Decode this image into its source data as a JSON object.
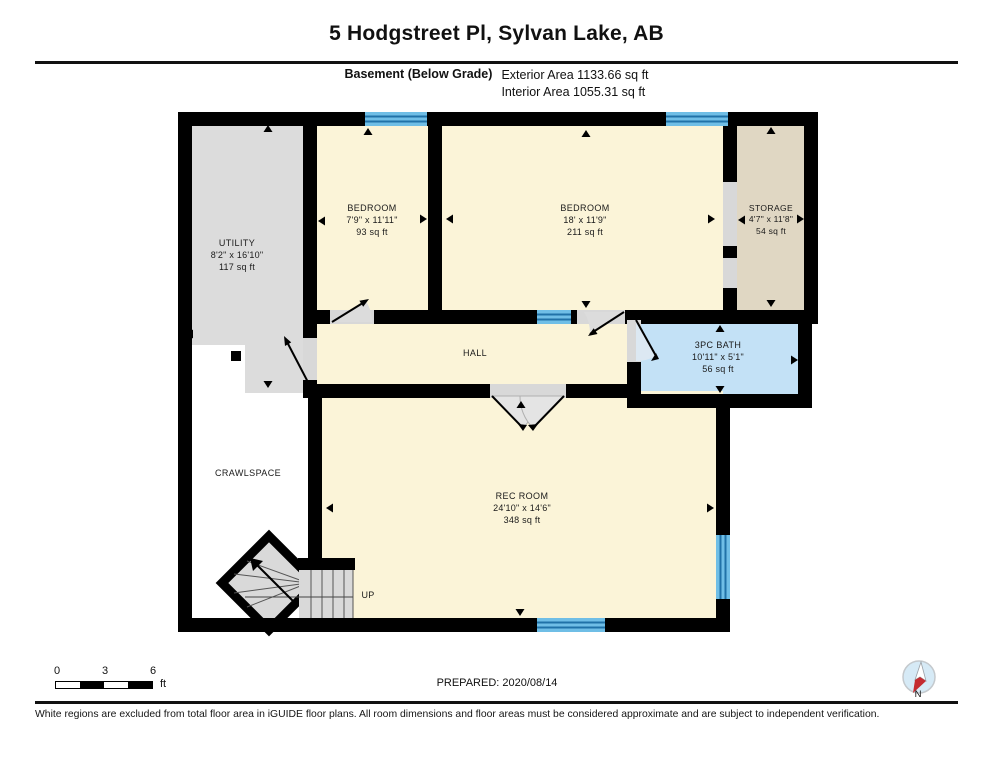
{
  "header": {
    "title": "5 Hodgstreet Pl, Sylvan Lake, AB",
    "floor_label": "Basement (Below Grade)",
    "exterior_area": "Exterior Area 1133.66 sq ft",
    "interior_area": "Interior Area 1055.31 sq ft"
  },
  "rooms": {
    "utility": {
      "name": "UTILITY",
      "dims": "8'2\" x 16'10\"",
      "area": "117 sq ft"
    },
    "bedroom_small": {
      "name": "BEDROOM",
      "dims": "7'9\" x 11'11\"",
      "area": "93 sq ft"
    },
    "bedroom_large": {
      "name": "BEDROOM",
      "dims": "18' x 11'9\"",
      "area": "211 sq ft"
    },
    "storage": {
      "name": "STORAGE",
      "dims": "4'7\" x 11'8\"",
      "area": "54 sq ft"
    },
    "hall": {
      "name": "HALL"
    },
    "bath": {
      "name": "3PC BATH",
      "dims": "10'11\" x 5'1\"",
      "area": "56 sq ft"
    },
    "crawlspace": {
      "name": "CRAWLSPACE"
    },
    "rec_room": {
      "name": "REC ROOM",
      "dims": "24'10\" x 14'6\"",
      "area": "348 sq ft"
    },
    "stairs": {
      "label": "UP"
    }
  },
  "scale_bar": {
    "ticks": [
      "0",
      "3",
      "6"
    ],
    "unit": "ft"
  },
  "footer": {
    "prepared": "PREPARED: 2020/08/14",
    "compass_label": "N",
    "disclaimer": "White regions are excluded from total floor area in iGUIDE floor plans. All room dimensions and floor areas must be considered approximate and are subject to independent verification."
  },
  "colors": {
    "wall": "#000000",
    "floor_cream": "#FBF4D8",
    "utility_gray": "#DCDCDC",
    "storage_tan": "#E0D7C3",
    "bath_blue": "#C3E1F6",
    "window_blue": "#6FBEE6",
    "window_stripe": "#2072A8",
    "compass_red": "#C42B30",
    "compass_blue": "#D6EAF6"
  }
}
